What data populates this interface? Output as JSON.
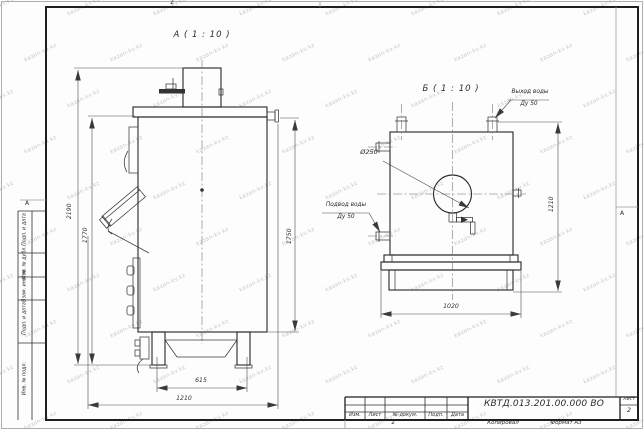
{
  "sheet": {
    "views": {
      "a_label": "А ( 1 : 10 )",
      "b_label": "Б ( 1 : 10 )"
    },
    "callouts": {
      "outlet_line1": "Выход воды",
      "outlet_line2": "Ду 50",
      "inlet_line1": "Подвод воды",
      "inlet_line2": "Ду 50",
      "hole_diameter": "Ø250"
    },
    "dimensions": {
      "a_overall_height": "2190",
      "a_left_height": "1770",
      "a_right_height": "1750",
      "a_base_width": "615",
      "a_overall_width": "1210",
      "b_width": "1020",
      "b_height": "1210"
    },
    "frame": {
      "left_column": [
        "Подп. и дата",
        "Инв. № дубл.",
        "Взам. инв. №",
        "Подп. и дата",
        "Инв. № подл."
      ],
      "zone_top": "2",
      "zone_bottom": "2",
      "zone_left": "А",
      "zone_right": "А"
    },
    "title_block": {
      "doc_number": "КВТД.013.201.00.000 ВО",
      "header_columns": [
        "Изм.",
        "Лист",
        "№ докум.",
        "Подп.",
        "Дата"
      ],
      "sheet_label": "Лист",
      "sheet_value": "2",
      "footer_copy": "Копировал",
      "footer_format": "Формат А3"
    },
    "watermark_text": "kazan-kv.kz"
  }
}
